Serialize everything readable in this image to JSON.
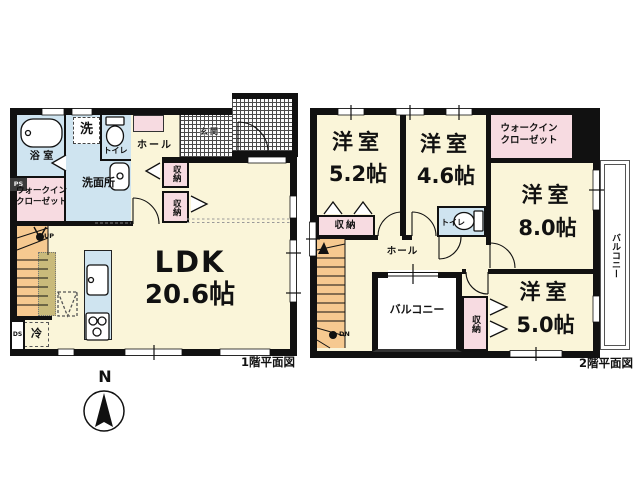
{
  "floor1": {
    "caption": "1階平面図",
    "bath": "浴 室",
    "wic_line1": "ウォークイン",
    "wic_line2": "クローゼット",
    "washer": "洗",
    "washroom": "洗面所",
    "toilet": "トイレ",
    "hall": "ホール",
    "entrance": "玄関",
    "storage_a": "収納",
    "storage_b": "収納",
    "ldk": "LDK",
    "ldk_size": "20.6帖",
    "fridge": "冷",
    "ps": "PS",
    "ds": "DS",
    "up": "UP"
  },
  "floor2": {
    "caption": "2階平面図",
    "room_a": "洋室",
    "room_a_size": "5.2帖",
    "room_b": "洋室",
    "room_b_size": "4.6帖",
    "room_c": "洋室",
    "room_c_size": "8.0帖",
    "room_d": "洋室",
    "room_d_size": "5.0帖",
    "wic_line1": "ウォークイン",
    "wic_line2": "クローゼット",
    "toilet": "トイレ",
    "hall": "ホール",
    "storage_top": "収納",
    "storage_side": "収納",
    "balcony_inner": "バルコニー",
    "balcony_side": "バルコニー",
    "dn": "DN"
  },
  "compass": {
    "north": "N"
  },
  "colors": {
    "wall": "#111111",
    "room_fill": "#faf5d9",
    "water_fill": "#cfe4f0",
    "closet_fill": "#f7dbe1",
    "stairs_fill": "#f6c990",
    "counter_fill": "#c9ba7b"
  }
}
